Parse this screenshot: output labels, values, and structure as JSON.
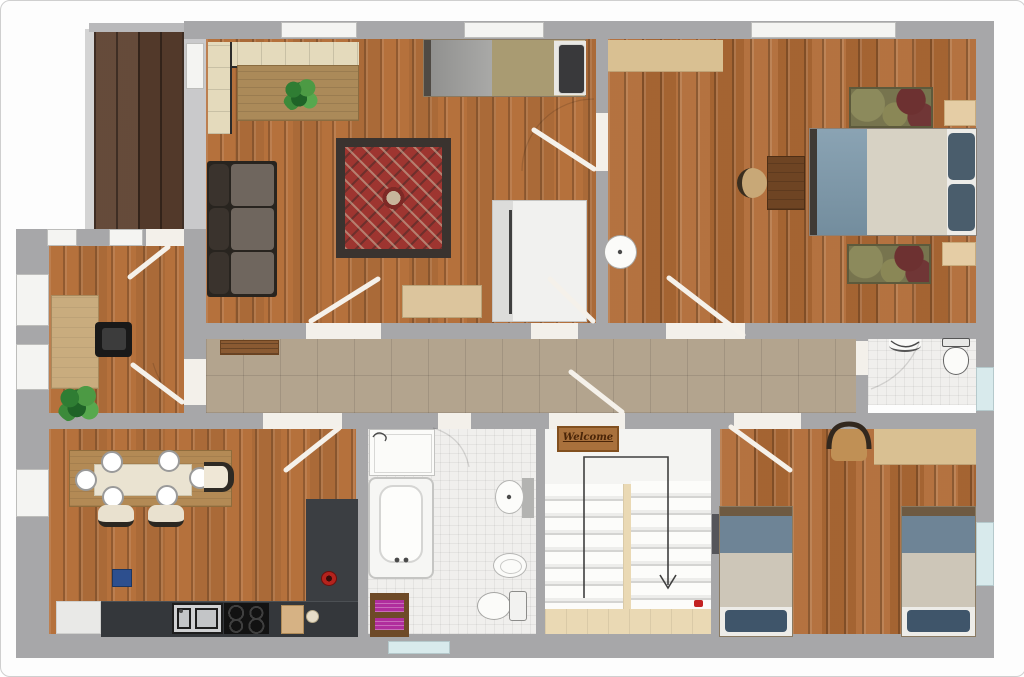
{
  "plan": {
    "type": "apartment-floor-plan",
    "welcome_mat": {
      "text": "Welcome"
    },
    "stairs": {
      "direction_indicator": "arrow-down"
    },
    "palette": {
      "wall_gray": "#a7a7a9",
      "wall_light_gray": "#c9c9cb",
      "wood_floor": "#b5713c",
      "wood_floor_dark": "#b06b36",
      "deck_wood": "#5d4130",
      "hallway_tile": "#b3a48e",
      "bathroom_tile": "#f0efed",
      "window_white": "#f4f4f2",
      "window_glass_blue": "#d8eaec",
      "rug_red": "#9e3530",
      "rug_border": "#3a332f",
      "rug_olive": "#77744e",
      "sofa_gray_brown": "#6f665e",
      "bench_cream": "#e4dabc",
      "table_wood": "#ab8a59",
      "bed_blanket_blue": "#7d99ab",
      "bed_blanket_cream": "#d7d2c4",
      "bed_blanket_gray": "#9d9d9b",
      "bed_blanket_khaki": "#a99b72",
      "pillow_dark_blue": "#4a5d6c",
      "kitchen_counter": "#35383c",
      "cooktop_black": "#121212",
      "towel_magenta": "#b02d9d",
      "bin_blue": "#2d4f8e",
      "stairs_wood": "#ead9b4",
      "mat_brown": "#a9713c",
      "red_dot": "#c32222",
      "wardrobe_white": "#f1f1ef",
      "dresser_tan": "#d9c092"
    },
    "rooms": [
      {
        "name": "balcony-deck",
        "floor": "dark-wood",
        "furniture": []
      },
      {
        "name": "living-room",
        "floor": "wood",
        "furniture": [
          "corner-bench",
          "dining-table",
          "potted-plant",
          "sofa",
          "oriental-rug",
          "single-bed",
          "wardrobe",
          "sideboard"
        ]
      },
      {
        "name": "master-bedroom",
        "floor": "wood",
        "furniture": [
          "double-bed",
          "two-pillows",
          "rug-top",
          "rug-bottom",
          "nightstand-top",
          "nightstand-bottom",
          "desk",
          "stool",
          "wall-sink",
          "dresser"
        ]
      },
      {
        "name": "office-room",
        "floor": "wood",
        "furniture": [
          "desk",
          "office-chair",
          "potted-plant"
        ]
      },
      {
        "name": "hallway",
        "floor": "tile",
        "furniture": [
          "shoe-bench"
        ]
      },
      {
        "name": "kitchen-dining",
        "floor": "wood",
        "furniture": [
          "dining-table",
          "six-plates",
          "chairs",
          "l-shaped-counter",
          "double-sink",
          "cooktop",
          "cutting-board",
          "red-bowl",
          "blue-bin",
          "white-cabinet"
        ]
      },
      {
        "name": "bathroom",
        "floor": "white-tile",
        "furniture": [
          "vanity-sink",
          "bathtub",
          "wall-sink",
          "bidet",
          "toilet",
          "towel-rack-magenta",
          "frosted-window"
        ]
      },
      {
        "name": "staircase",
        "floor": "white-and-wood",
        "furniture": [
          "welcome-mat",
          "u-shaped-stairs",
          "direction-arrow",
          "red-marker"
        ]
      },
      {
        "name": "twin-bedroom",
        "floor": "wood",
        "furniture": [
          "single-bed-left",
          "single-bed-right",
          "chair",
          "desk"
        ]
      },
      {
        "name": "wc",
        "floor": "white-tile",
        "furniture": [
          "corner-sink",
          "toilet"
        ]
      }
    ]
  }
}
